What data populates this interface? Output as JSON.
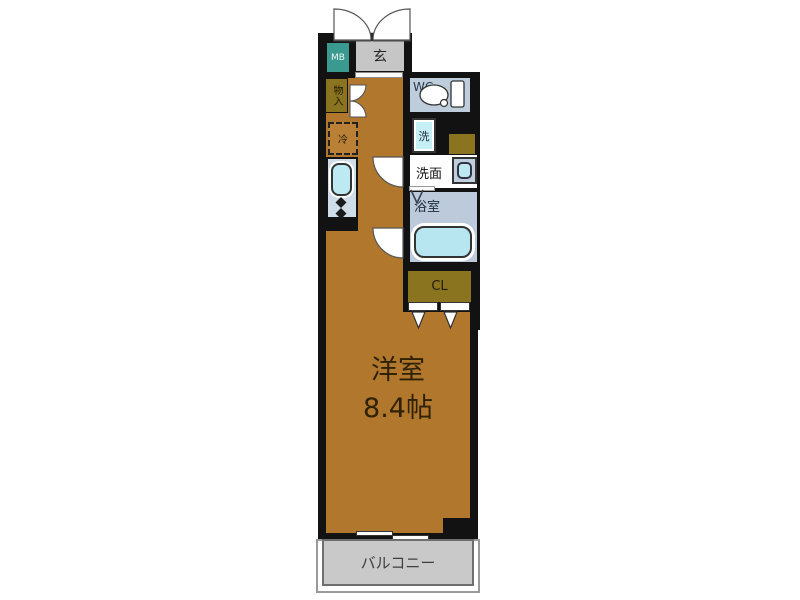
{
  "plan": {
    "rooms": {
      "meter_box": {
        "label": "MB"
      },
      "entrance": {
        "label": "玄"
      },
      "storage": {
        "label": "物入"
      },
      "wc": {
        "label": "WC"
      },
      "refrigerator_space": {
        "label": "冷"
      },
      "laundry_pan": {
        "label": "洗"
      },
      "washroom": {
        "label": "洗面"
      },
      "bathroom": {
        "label": "浴室"
      },
      "closet": {
        "label": "CL"
      },
      "western_room": {
        "label": "洋室",
        "size": "8.4帖"
      },
      "balcony": {
        "label": "バルコニー"
      }
    },
    "colors": {
      "wall": "#121212",
      "floor_ochre": "#b1782d",
      "storage_olive": "#8a741f",
      "meter_box_teal": "#3b9a90",
      "entrance_gray": "#c6c6c6",
      "wet_area_blue": "#becddb",
      "fixture_cyan": "#bce9f2",
      "balcony_gray": "#c9c9c9"
    }
  }
}
